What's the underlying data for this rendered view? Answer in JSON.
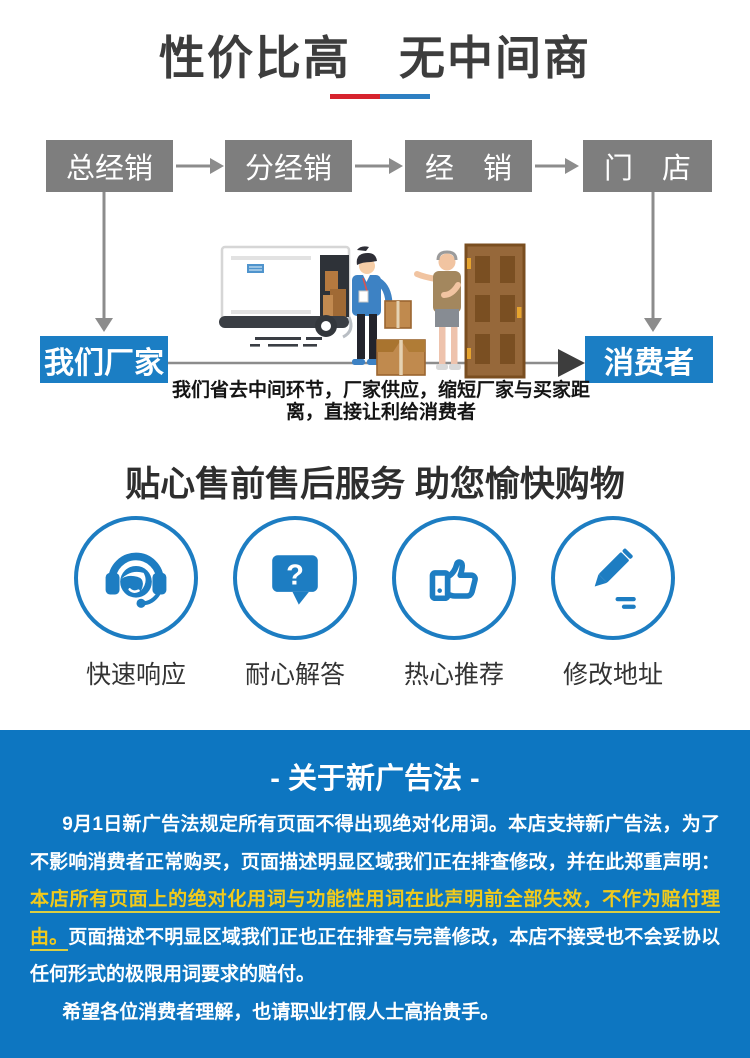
{
  "header": {
    "title": "性价比高　无中间商",
    "underline_left_color": "#d7232e",
    "underline_right_color": "#2e80c3"
  },
  "flow": {
    "top_boxes": [
      {
        "label": "总经销"
      },
      {
        "label": "分经销"
      },
      {
        "label": "经　销"
      },
      {
        "label": "门　店"
      }
    ],
    "factory_label": "我们厂家",
    "consumer_label": "消费者",
    "caption_line1": "我们省去中间环节，厂家供应，缩短厂家与买家距",
    "caption_line2": "离，直接让利给消费者",
    "box_gray": "#7e7e7e",
    "box_blue": "#1b7ec4"
  },
  "services": {
    "title": "贴心售前售后服务 助您愉快购物",
    "accent_color": "#1d7dc2",
    "items": [
      {
        "icon": "headset-icon",
        "label": "快速响应"
      },
      {
        "icon": "question-bubble-icon",
        "label": "耐心解答",
        "glyph": "?"
      },
      {
        "icon": "thumbs-up-icon",
        "label": "热心推荐"
      },
      {
        "icon": "pencil-icon",
        "label": "修改地址"
      }
    ]
  },
  "notice": {
    "title": "- 关于新广告法 -",
    "background": "#0d76c1",
    "highlight_color": "#f1ca1b",
    "p1_before": "9月1日新广告法规定所有页面不得出现绝对化用词。本店支持新广告法，为了不影响消费者正常购买，页面描述明显区域我们正在排查修改，并在此郑重声明：",
    "p1_highlight": "本店所有页面上的绝对化用词与功能性用词在此声明前全部失效，不作为赔付理由。",
    "p1_after": "页面描述不明显区域我们正也正在排查与完善修改，本店不接受也不会妥协以任何形式的极限用词要求的赔付。",
    "p2": "希望各位消费者理解，也请职业打假人士高抬贵手。"
  }
}
